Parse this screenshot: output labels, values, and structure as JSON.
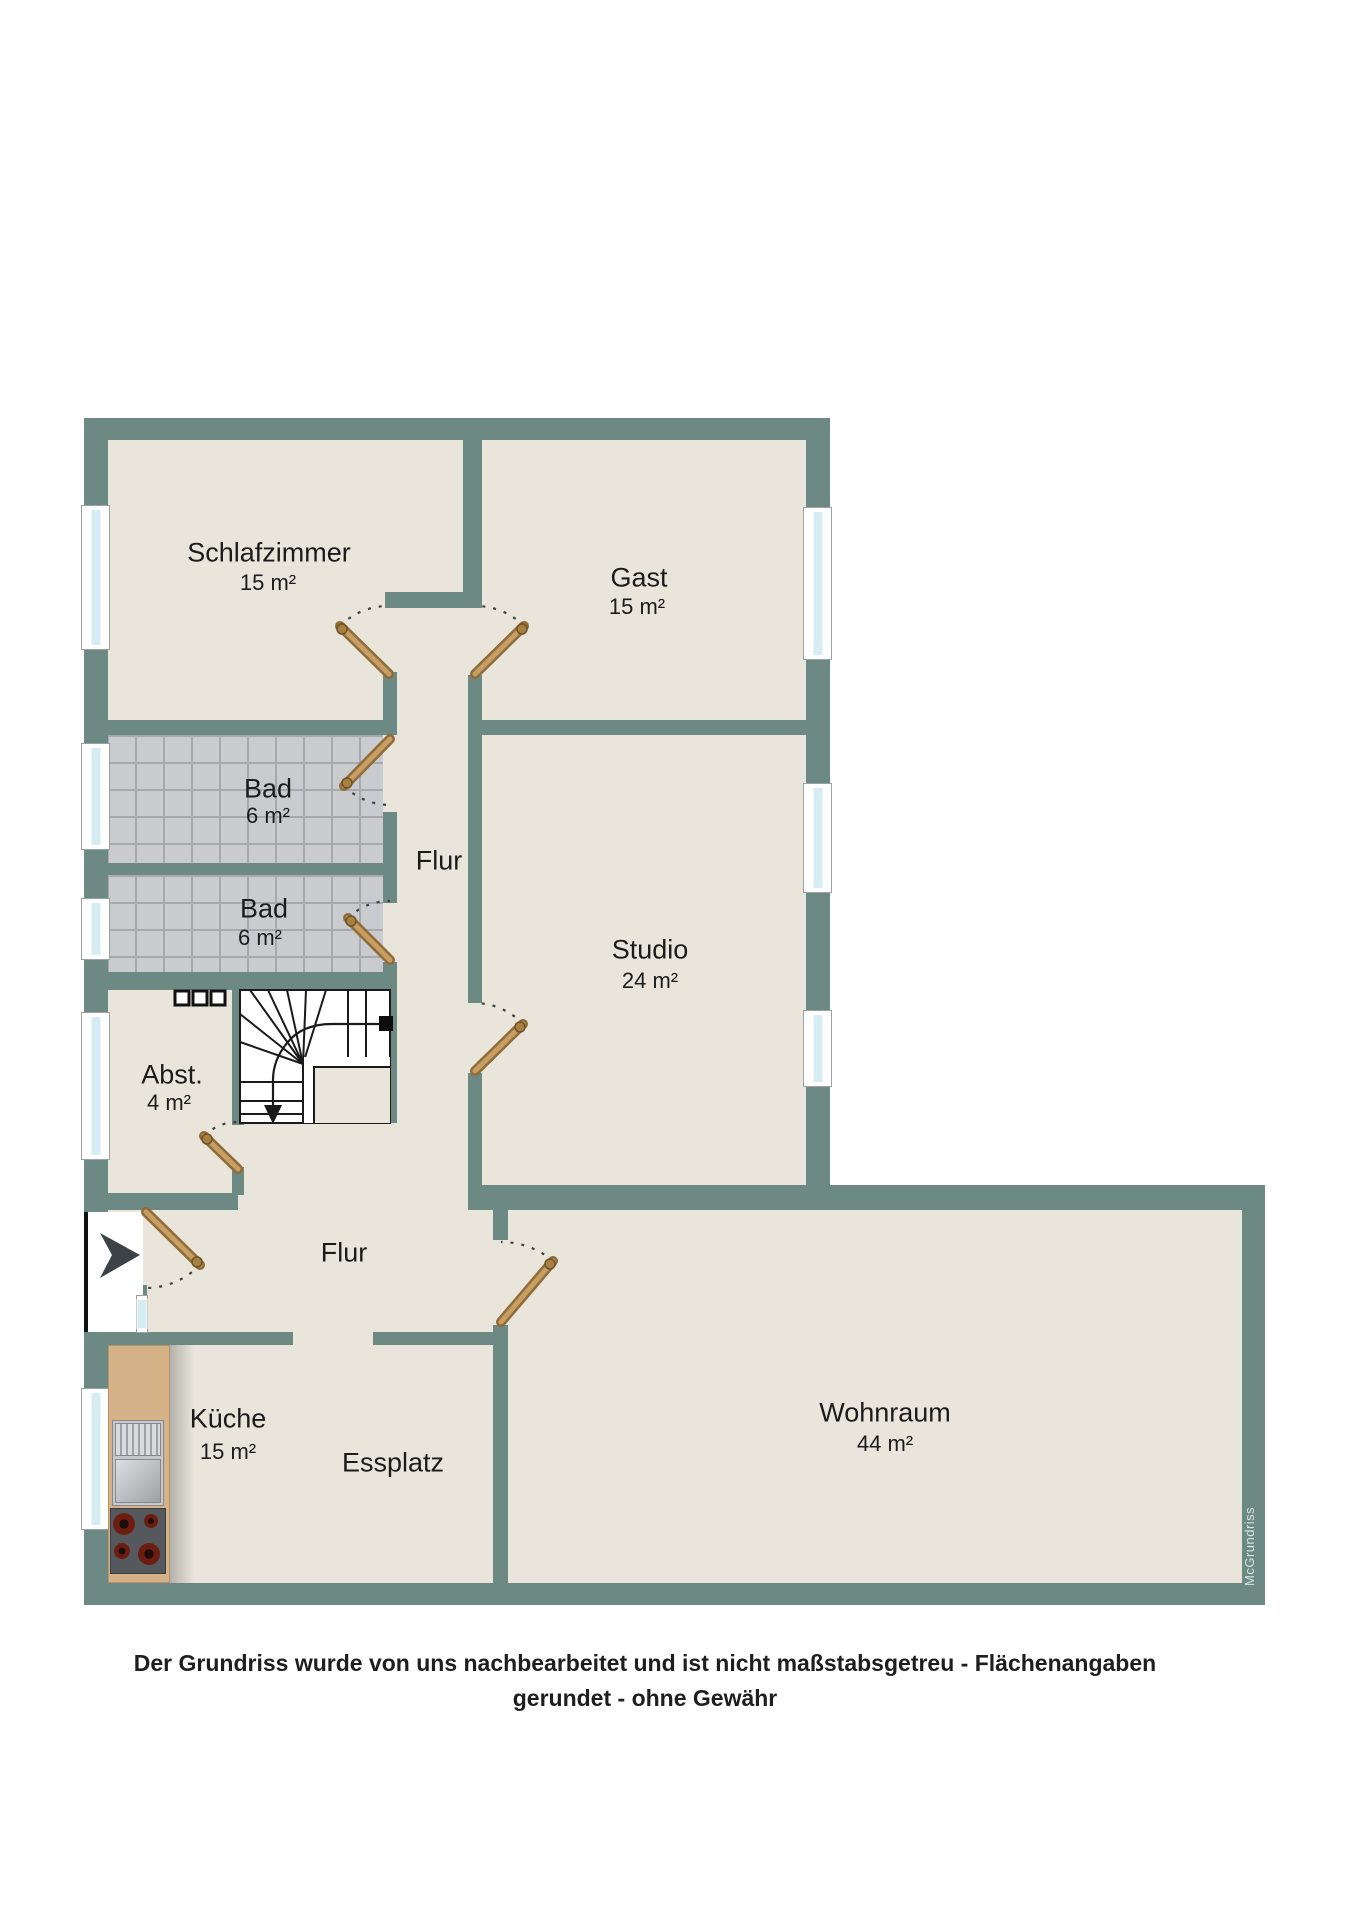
{
  "plan": {
    "rooms": [
      {
        "name": "Schlafzimmer",
        "area": "15 m²"
      },
      {
        "name": "Gast",
        "area": "15 m²"
      },
      {
        "name": "Bad",
        "area": "6 m²"
      },
      {
        "name": "Bad",
        "area": "6 m²"
      },
      {
        "name": "Flur",
        "area": ""
      },
      {
        "name": "Studio",
        "area": "24 m²"
      },
      {
        "name": "Abst.",
        "area": "4 m²"
      },
      {
        "name": "Flur",
        "area": ""
      },
      {
        "name": "Küche",
        "area": "15 m²"
      },
      {
        "name": "Essplatz",
        "area": ""
      },
      {
        "name": "Wohnraum",
        "area": "44 m²"
      }
    ],
    "watermark": "McGrundriss",
    "colors": {
      "wall": "#6C8A83",
      "floor": "#E9E5DB",
      "bath_tile": "#C9CBCE",
      "window_pane": "#D4ECF2",
      "door_wood": "#BE9459",
      "entry_arrow": "#3C4347"
    }
  },
  "caption": {
    "line1": "Der Grundriss wurde von uns nachbearbeitet und ist nicht maßstabsgetreu - Flächenangaben",
    "line2": "gerundet - ohne Gewähr"
  }
}
